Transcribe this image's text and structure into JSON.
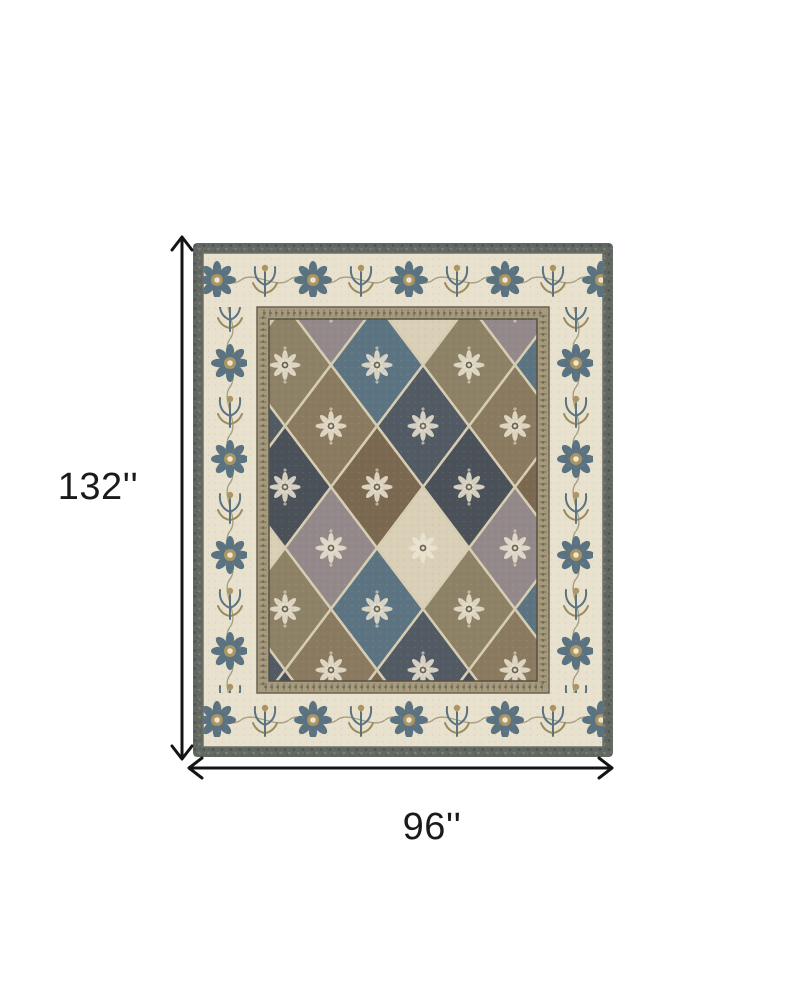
{
  "page": {
    "background_color": "#ffffff"
  },
  "dimensions": {
    "height_label": "132''",
    "width_label": "96''",
    "arrow_color": "#141414",
    "label_color": "#1a1a1a"
  },
  "rug": {
    "palette": {
      "outer_band": "#646862",
      "ivory_border": "#e8e1cd",
      "guard_band": "#a59a7c",
      "field_cream": "#d9d0b7",
      "field_charcoal": "#4b5159",
      "field_brown": "#7b6850",
      "field_taupe": "#94898a",
      "field_teal": "#5c7482",
      "field_olive": "#8d8166",
      "field_slate": "#525a64",
      "motif_blue": "#5b7280",
      "motif_tan": "#ab9560"
    }
  }
}
